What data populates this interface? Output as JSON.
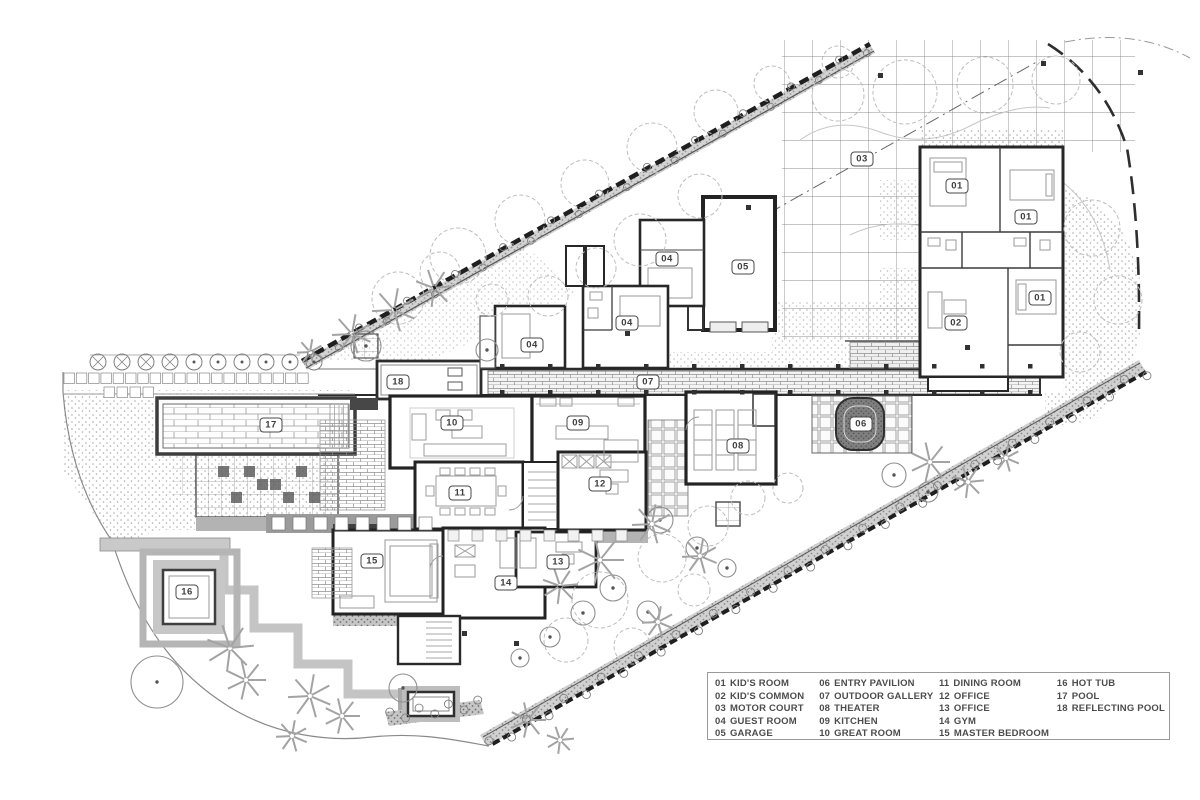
{
  "colors": {
    "paper": "#ffffff",
    "ink": "#2e2e2e",
    "wall": "#262626",
    "mid_gray": "#8a8a8a",
    "light_gray": "#c4c4c4",
    "hedge": "#1f1f1f",
    "dark_fill": "#4c4c4c"
  },
  "plan": {
    "labels": [
      {
        "num": "01",
        "x": 957,
        "y": 186
      },
      {
        "num": "01",
        "x": 1026,
        "y": 217
      },
      {
        "num": "01",
        "x": 1040,
        "y": 298
      },
      {
        "num": "02",
        "x": 956,
        "y": 323
      },
      {
        "num": "03",
        "x": 862,
        "y": 159
      },
      {
        "num": "04",
        "x": 667,
        "y": 259
      },
      {
        "num": "04",
        "x": 627,
        "y": 323
      },
      {
        "num": "04",
        "x": 532,
        "y": 345
      },
      {
        "num": "05",
        "x": 743,
        "y": 267
      },
      {
        "num": "06",
        "x": 861,
        "y": 424
      },
      {
        "num": "07",
        "x": 648,
        "y": 382
      },
      {
        "num": "08",
        "x": 738,
        "y": 446
      },
      {
        "num": "09",
        "x": 578,
        "y": 423
      },
      {
        "num": "10",
        "x": 452,
        "y": 423
      },
      {
        "num": "11",
        "x": 460,
        "y": 493
      },
      {
        "num": "12",
        "x": 600,
        "y": 484
      },
      {
        "num": "13",
        "x": 558,
        "y": 562
      },
      {
        "num": "14",
        "x": 506,
        "y": 583
      },
      {
        "num": "15",
        "x": 372,
        "y": 561
      },
      {
        "num": "16",
        "x": 187,
        "y": 592
      },
      {
        "num": "17",
        "x": 271,
        "y": 425
      },
      {
        "num": "18",
        "x": 398,
        "y": 382
      }
    ]
  },
  "legend": {
    "columns": [
      [
        {
          "num": "01",
          "label": "KID'S ROOM"
        },
        {
          "num": "02",
          "label": "KID'S COMMON"
        },
        {
          "num": "03",
          "label": "MOTOR COURT"
        },
        {
          "num": "04",
          "label": "GUEST ROOM"
        },
        {
          "num": "05",
          "label": "GARAGE"
        }
      ],
      [
        {
          "num": "06",
          "label": "ENTRY PAVILION"
        },
        {
          "num": "07",
          "label": "OUTDOOR GALLERY"
        },
        {
          "num": "08",
          "label": "THEATER"
        },
        {
          "num": "09",
          "label": "KITCHEN"
        },
        {
          "num": "10",
          "label": "GREAT ROOM"
        }
      ],
      [
        {
          "num": "11",
          "label": "DINING ROOM"
        },
        {
          "num": "12",
          "label": "OFFICE"
        },
        {
          "num": "13",
          "label": "OFFICE"
        },
        {
          "num": "14",
          "label": "GYM"
        },
        {
          "num": "15",
          "label": "MASTER BEDROOM"
        }
      ],
      [
        {
          "num": "16",
          "label": "HOT TUB"
        },
        {
          "num": "17",
          "label": "POOL"
        },
        {
          "num": "18",
          "label": "REFLECTING POOL"
        }
      ]
    ]
  }
}
